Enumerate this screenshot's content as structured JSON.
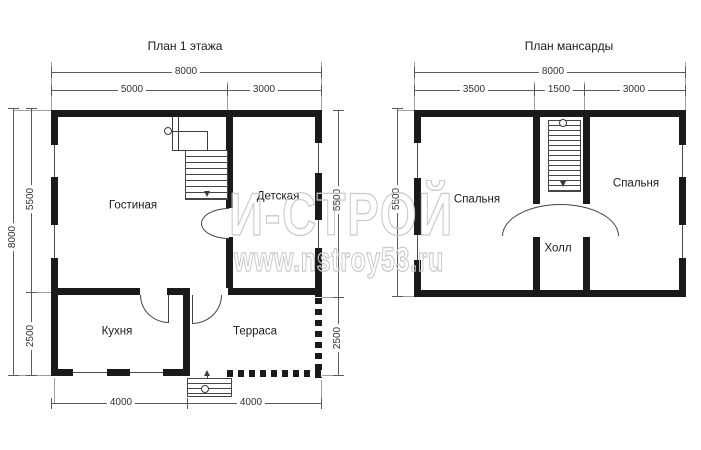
{
  "watermark": {
    "brand": "И-СТРОЙ",
    "url": "www.nstroy53.ru",
    "outline_color": "#c9c9c9"
  },
  "colors": {
    "background": "#ffffff",
    "wall": "#1a1a1a",
    "thin_line": "#3c3c3c",
    "dimension_line": "#5a5a5a"
  },
  "plan_first_floor": {
    "title": "План 1 этажа",
    "rooms": {
      "living": "Гостиная",
      "kids": "Детская",
      "kitchen": "Кухня",
      "terrace": "Терраса"
    },
    "dims": {
      "top_total": "8000",
      "top_left": "5000",
      "top_right": "3000",
      "left_total": "8000",
      "left_upper": "5500",
      "left_lower": "2500",
      "right_upper": "5500",
      "right_lower": "2500",
      "bottom_left": "4000",
      "bottom_right": "4000"
    }
  },
  "plan_attic": {
    "title": "План мансарды",
    "rooms": {
      "bedroom_left": "Спальня",
      "bedroom_right": "Спальня",
      "hall": "Холл"
    },
    "dims": {
      "top_total": "8000",
      "top_left": "3500",
      "top_middle": "1500",
      "top_right": "3000",
      "left": "5500"
    }
  }
}
